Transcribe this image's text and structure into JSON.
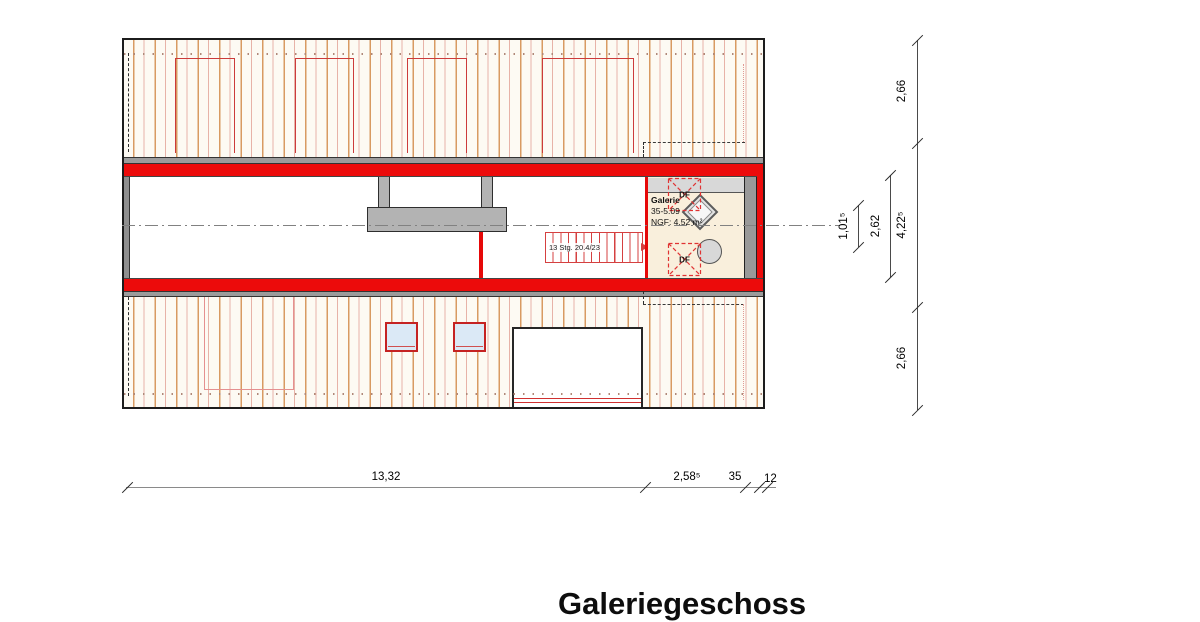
{
  "title_block": {
    "floor_title": "Galeriegeschoss"
  },
  "plan": {
    "room": {
      "name": "Galerie",
      "number": "35-5.09",
      "area_label": "NGF: 4,52 m²"
    },
    "stair": {
      "label": "13 Stg. 20.4/23"
    },
    "roof_window_top": {
      "label": "DF"
    },
    "roof_window_bottom": {
      "label": "DF"
    }
  },
  "dimensions": {
    "bottom": {
      "overall": "13,32",
      "gallery": "2,58⁵",
      "wall": "35",
      "edge": "12"
    },
    "right": {
      "roof_top": "2,66",
      "middle": "4,22⁵",
      "roof_bottom": "2,66",
      "room_width": "2,62",
      "inner": "1,01⁵"
    }
  },
  "colors": {
    "wall_red": "#ec0b0b",
    "marker_red": "#cc3333",
    "roof_stripe_orange": "#d89a62",
    "floor_cream": "#f9efdc",
    "skylight_blue": "#dbe9f6",
    "gray_wall": "#9c9c9c"
  }
}
